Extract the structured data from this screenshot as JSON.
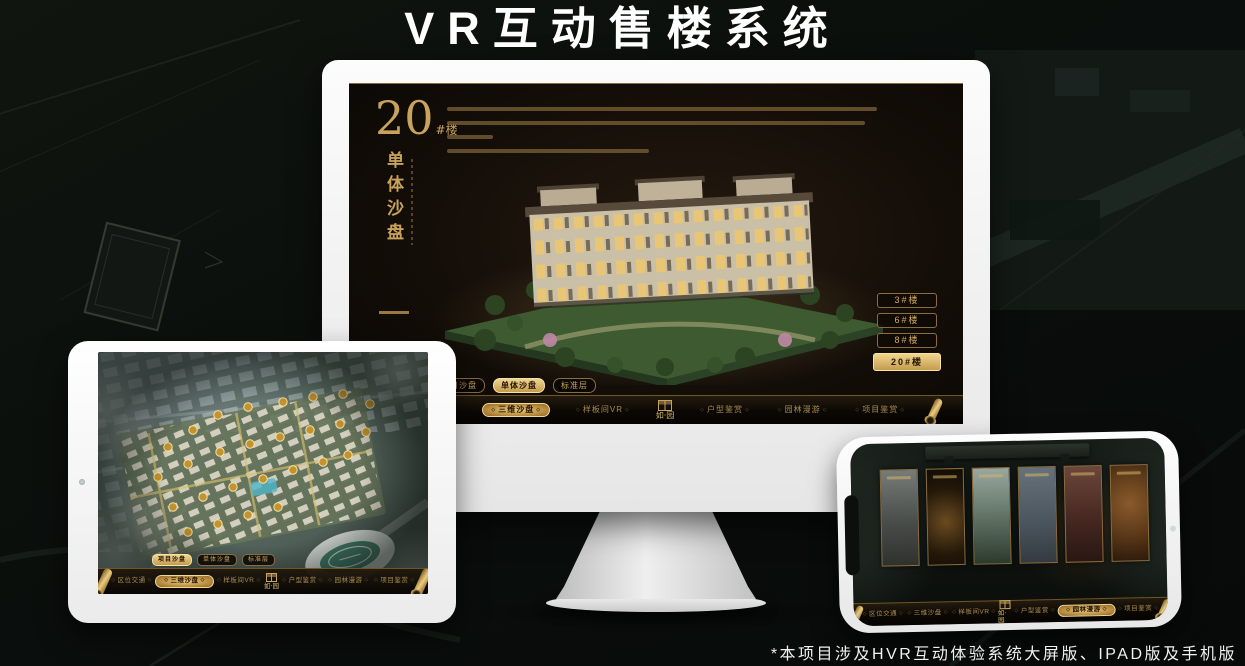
{
  "page": {
    "title": "VR互动售楼系统",
    "footnote": "*本项目涉及HVR互动体验系统大屏版、IPAD版及手机版"
  },
  "brand": {
    "logo_text": "如·园"
  },
  "tabs": [
    "项目沙盘",
    "单体沙盘",
    "标准层"
  ],
  "nav": {
    "items": [
      "区位交通",
      "三维沙盘",
      "样板间VR",
      "户型鉴赏",
      "园林漫游",
      "项目鉴赏"
    ]
  },
  "monitor_screen": {
    "headline_number": "20",
    "headline_unit": "#楼",
    "headline_subtitle": "单体沙盘",
    "building_buttons": [
      "3#楼",
      "6#楼",
      "8#楼",
      "20#楼"
    ],
    "active_building_button": "20#楼",
    "active_tab": "单体沙盘",
    "active_nav_item": "三维沙盘"
  },
  "tablet_screen": {
    "active_tab": "项目沙盘",
    "active_nav_item": "三维沙盘"
  },
  "phone_screen": {
    "active_nav_item": "园林漫游"
  },
  "colors": {
    "gold": "#c9a35c",
    "gold_bright": "#eed28a",
    "screen_bg": "#16100a",
    "background": "#0b0f0d"
  }
}
